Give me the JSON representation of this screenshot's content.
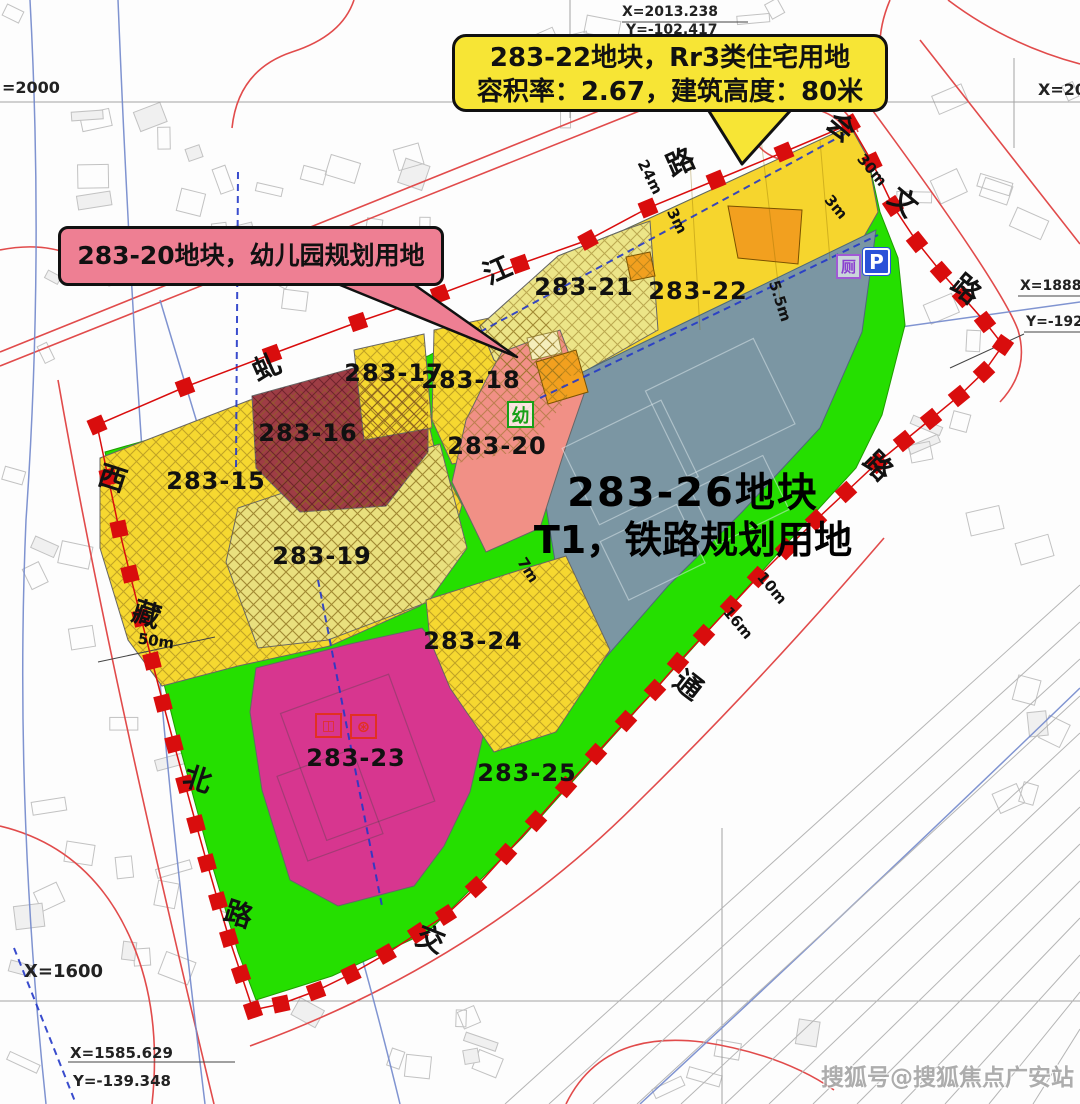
{
  "callout_22": {
    "line1": "283-22地块，Rr3类住宅用地",
    "line2": "容积率：2.67，建筑高度：80米"
  },
  "callout_20": {
    "text": "283-20地块，幼儿园规划用地"
  },
  "parcel_26_title": {
    "line1": "283-26地块",
    "line2": "T1，铁路规划用地"
  },
  "watermark": "搜狐号@搜狐焦点广安站",
  "icons": {
    "kindergarten": "幼",
    "toilet": "厕",
    "parking": "P",
    "facility1": "◫",
    "facility2": "⊛"
  },
  "colors": {
    "boundary_red": "#d90d0d",
    "site_green": "#25df00",
    "residential_yellow": "#f6d830",
    "pale_yellow": "#e9e07e",
    "dark_red": "#9e3d45",
    "kindergarten_pink": "#f19086",
    "magenta": "#d7368f",
    "railway_gray": "#7b96a3",
    "orange": "#f2a01f",
    "callout_yellow": "#f7e535",
    "callout_pink": "#ee7f93"
  },
  "parcel_labels": [
    {
      "text": "283-15",
      "x": 216,
      "y": 481
    },
    {
      "text": "283-16",
      "x": 308,
      "y": 433
    },
    {
      "text": "283-17",
      "x": 394,
      "y": 373
    },
    {
      "text": "283-18",
      "x": 471,
      "y": 380
    },
    {
      "text": "283-19",
      "x": 322,
      "y": 556
    },
    {
      "text": "283-20",
      "x": 497,
      "y": 446
    },
    {
      "text": "283-21",
      "x": 584,
      "y": 287
    },
    {
      "text": "283-22",
      "x": 698,
      "y": 291
    },
    {
      "text": "283-23",
      "x": 356,
      "y": 758
    },
    {
      "text": "283-24",
      "x": 473,
      "y": 641
    },
    {
      "text": "283-25",
      "x": 527,
      "y": 773
    }
  ],
  "road_chars": [
    {
      "ch": "西",
      "x": 113,
      "y": 477,
      "rot": 18
    },
    {
      "ch": "藏",
      "x": 147,
      "y": 613,
      "rot": 18
    },
    {
      "ch": "北",
      "x": 198,
      "y": 778,
      "rot": 18
    },
    {
      "ch": "路",
      "x": 239,
      "y": 913,
      "rot": 18
    },
    {
      "ch": "虬",
      "x": 266,
      "y": 366,
      "rot": -24
    },
    {
      "ch": "江",
      "x": 497,
      "y": 269,
      "rot": -24
    },
    {
      "ch": "路",
      "x": 680,
      "y": 161,
      "rot": -24
    },
    {
      "ch": "会",
      "x": 842,
      "y": 126,
      "rot": 40
    },
    {
      "ch": "文",
      "x": 904,
      "y": 201,
      "rot": 40
    },
    {
      "ch": "路",
      "x": 967,
      "y": 288,
      "rot": 40
    },
    {
      "ch": "路",
      "x": 879,
      "y": 465,
      "rot": 45
    },
    {
      "ch": "通",
      "x": 689,
      "y": 684,
      "rot": 38
    },
    {
      "ch": "交",
      "x": 431,
      "y": 938,
      "rot": 22
    }
  ],
  "dimensions": [
    {
      "text": "24m",
      "x": 650,
      "y": 177,
      "rot": 63
    },
    {
      "text": "3m",
      "x": 677,
      "y": 221,
      "rot": 63
    },
    {
      "text": "30m",
      "x": 872,
      "y": 170,
      "rot": 50
    },
    {
      "text": "3m",
      "x": 836,
      "y": 207,
      "rot": 50
    },
    {
      "text": "5.5m",
      "x": 780,
      "y": 301,
      "rot": 72
    },
    {
      "text": "50m",
      "x": 156,
      "y": 641,
      "rot": 8
    },
    {
      "text": "7m",
      "x": 528,
      "y": 570,
      "rot": 58
    },
    {
      "text": "16m",
      "x": 738,
      "y": 623,
      "rot": 50
    },
    {
      "text": "10m",
      "x": 772,
      "y": 588,
      "rot": 50
    }
  ],
  "coord_labels": [
    {
      "text": "X=2013.238",
      "x": 622,
      "y": 4,
      "size": 14
    },
    {
      "text": "Y=-102.417",
      "x": 626,
      "y": 22,
      "size": 14
    },
    {
      "text": "=2000",
      "x": 2,
      "y": 78,
      "size": 16
    },
    {
      "text": "X=200",
      "x": 1038,
      "y": 80,
      "size": 16
    },
    {
      "text": "X=1888.",
      "x": 1020,
      "y": 278,
      "size": 14
    },
    {
      "text": "Y=-192.",
      "x": 1026,
      "y": 314,
      "size": 14
    },
    {
      "text": "Y=-211.211",
      "x": 182,
      "y": 268,
      "size": 14
    },
    {
      "text": "X=1600",
      "x": 24,
      "y": 961,
      "size": 18
    },
    {
      "text": "X=1585.629",
      "x": 70,
      "y": 1044,
      "size": 15
    },
    {
      "text": "Y=-139.348",
      "x": 73,
      "y": 1072,
      "size": 15
    }
  ]
}
